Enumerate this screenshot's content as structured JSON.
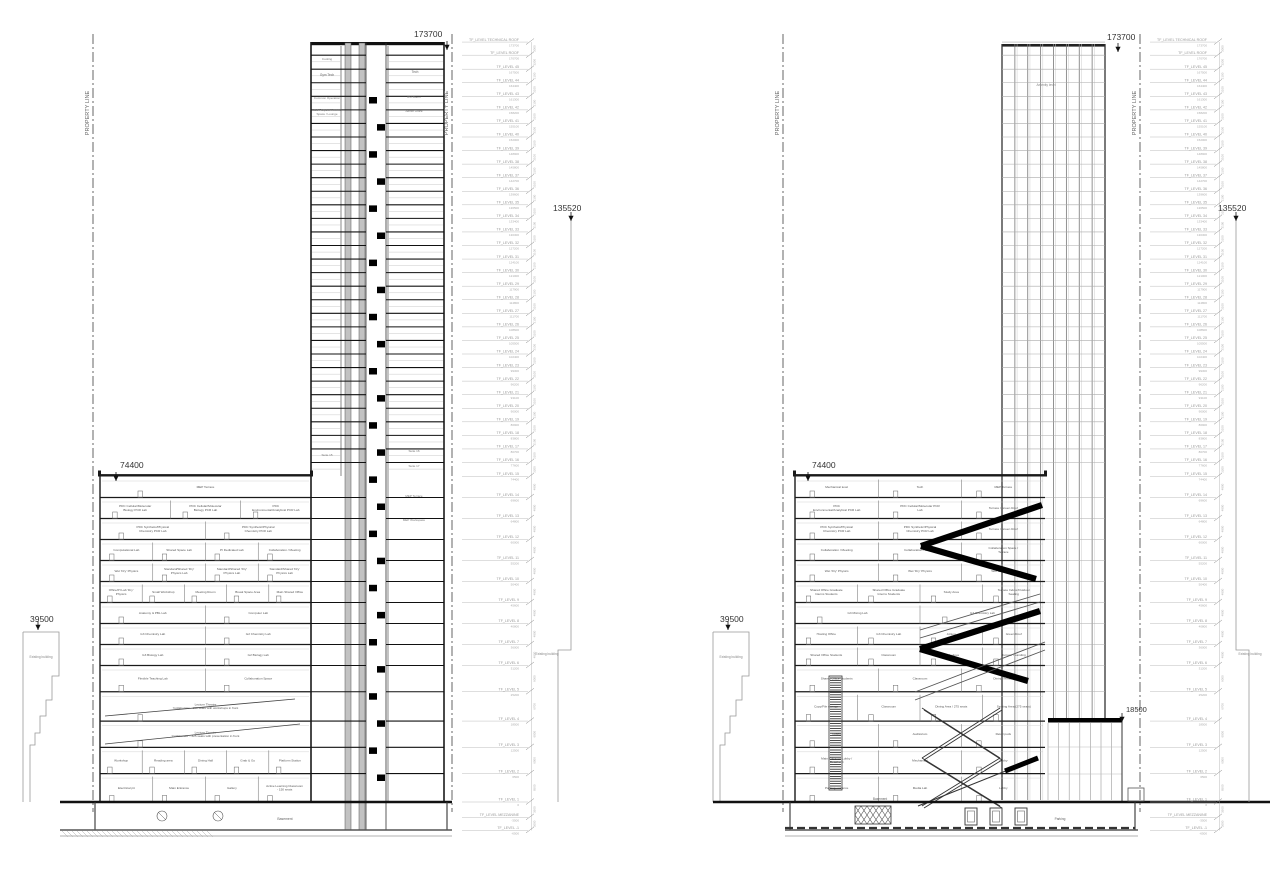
{
  "annotations": {
    "property_line": "PROPERTY LINE",
    "existing_building": "Existing building"
  },
  "markers": {
    "left_section": {
      "roof": "173700",
      "podium_roof": "74400",
      "existing_left": "39500",
      "existing_right": "135520"
    },
    "right_section": {
      "roof": "173700",
      "podium_roof": "74400",
      "existing_left": "39500",
      "existing_right": "135520",
      "annex_roof": "18500"
    }
  },
  "levels": [
    {
      "name": "TF_LEVEL TECHNICAL ROOF",
      "elev": 173700
    },
    {
      "name": "TF_LEVEL ROOF",
      "elev": 170700
    },
    {
      "name": "TF_LEVEL 45",
      "elev": 167500
    },
    {
      "name": "TF_LEVEL 44",
      "elev": 164400
    },
    {
      "name": "TF_LEVEL 43",
      "elev": 161300
    },
    {
      "name": "TF_LEVEL 42",
      "elev": 158200
    },
    {
      "name": "TF_LEVEL 41",
      "elev": 155100
    },
    {
      "name": "TF_LEVEL 40",
      "elev": 152000
    },
    {
      "name": "TF_LEVEL 39",
      "elev": 148900
    },
    {
      "name": "TF_LEVEL 38",
      "elev": 145800
    },
    {
      "name": "TF_LEVEL 37",
      "elev": 142700
    },
    {
      "name": "TF_LEVEL 36",
      "elev": 139600
    },
    {
      "name": "TF_LEVEL 35",
      "elev": 136500
    },
    {
      "name": "TF_LEVEL 34",
      "elev": 133400
    },
    {
      "name": "TF_LEVEL 33",
      "elev": 130300
    },
    {
      "name": "TF_LEVEL 32",
      "elev": 127200
    },
    {
      "name": "TF_LEVEL 31",
      "elev": 124100
    },
    {
      "name": "TF_LEVEL 30",
      "elev": 121000
    },
    {
      "name": "TF_LEVEL 29",
      "elev": 117900
    },
    {
      "name": "TF_LEVEL 28",
      "elev": 114800
    },
    {
      "name": "TF_LEVEL 27",
      "elev": 111700
    },
    {
      "name": "TF_LEVEL 26",
      "elev": 108600
    },
    {
      "name": "TF_LEVEL 25",
      "elev": 105500
    },
    {
      "name": "TF_LEVEL 24",
      "elev": 102400
    },
    {
      "name": "TF_LEVEL 23",
      "elev": 99300
    },
    {
      "name": "TF_LEVEL 22",
      "elev": 96200
    },
    {
      "name": "TF_LEVEL 21",
      "elev": 93100
    },
    {
      "name": "TF_LEVEL 20",
      "elev": 90000
    },
    {
      "name": "TF_LEVEL 19",
      "elev": 86900
    },
    {
      "name": "TF_LEVEL 18",
      "elev": 83800
    },
    {
      "name": "TF_LEVEL 17",
      "elev": 80700
    },
    {
      "name": "TF_LEVEL 16",
      "elev": 77600
    },
    {
      "name": "TF_LEVEL 15",
      "elev": 74400
    },
    {
      "name": "TF_LEVEL 14",
      "elev": 69600
    },
    {
      "name": "TF_LEVEL 13",
      "elev": 64800
    },
    {
      "name": "TF_LEVEL 12",
      "elev": 60000
    },
    {
      "name": "TF_LEVEL 11",
      "elev": 55200
    },
    {
      "name": "TF_LEVEL 10",
      "elev": 50400
    },
    {
      "name": "TF_LEVEL 9",
      "elev": 45600
    },
    {
      "name": "TF_LEVEL 8",
      "elev": 40800
    },
    {
      "name": "TF_LEVEL 7",
      "elev": 36000
    },
    {
      "name": "TF_LEVEL 6",
      "elev": 31200
    },
    {
      "name": "TF_LEVEL 5",
      "elev": 25200
    },
    {
      "name": "TF_LEVEL 4",
      "elev": 18500
    },
    {
      "name": "TF_LEVEL 3",
      "elev": 12500
    },
    {
      "name": "TF_LEVEL 2",
      "elev": 6500
    },
    {
      "name": "TF_LEVEL 1",
      "elev": 0
    },
    {
      "name": "TF_LEVEL MEZZANINE",
      "elev": -3500
    },
    {
      "name": "TF_LEVEL -1",
      "elev": -6500
    }
  ],
  "left_section": {
    "tower_top_labels": {
      "cooling": "Cooling",
      "gym_tech": "Gym Tech",
      "tech": "Tech",
      "common_operation": "Common Operation",
      "ru_room": "RU Room",
      "amenity": "Multi-Purpose Amenity Space / Lounge",
      "admin_office": "Admin Office"
    },
    "suite_labels": [
      "Suite 15",
      "Suite 16",
      "Suite 17"
    ],
    "mep_labels": [
      "MEP Terrace",
      "MEP Workspace"
    ],
    "podium_floors": [
      [
        "MEP Terrace"
      ],
      [
        "PDC Cellular/Molecular Biology PCR Lab",
        "PDC Cellular/Molecular Biology PCR Lab",
        "PDC Environmental/Analytical PCR Lab"
      ],
      [
        "PDC Synthetic/Physical Chemistry PCR Lab",
        "PDC Synthetic/Physical Chemistry PCR Lab"
      ],
      [
        "Computational Lab",
        "Shared Space Lab",
        "PI Dedicated Lab",
        "Collaboration / Meeting"
      ],
      [
        "Wet 'Dry' Physics",
        "Standard/Shared 'Dry' Physics Lab",
        "Standard/Shared 'Dry' Physics Lab",
        "Standard/Shared 'Dry' Physics Lab"
      ],
      [
        "Office/PI Lab 'Dry' Physics",
        "Small Workshop",
        "Meeting Room",
        "Break Space Area",
        "Main Shared Office"
      ],
      [
        "Anatomy & PBL Lab",
        "Computer Lab"
      ],
      [
        "G3 Chemistry Lab",
        "G2 Chemistry Lab"
      ],
      [
        "G3 Biology Lab",
        "G2 Biology Lab"
      ],
      [
        "Flexible Teaching Lab",
        "Collaboration Space"
      ],
      [
        "Lecture Theatre 'Collaborate' - 150 seats with workshops in front"
      ],
      [
        "Lecture Theatre 'Collaborate' - 325 seats with presentation in front"
      ],
      [
        "Workshop",
        "Reading area",
        "Dining Hall",
        "Grab & Go",
        "Platform Station"
      ],
      [
        "Electrical pit",
        "Main Entrance",
        "Gallery",
        "Active Learning Classroom - 150 seats"
      ]
    ],
    "basement_label": "Basement"
  },
  "right_section": {
    "tower_label": "Amenity level",
    "podium_floors": [
      [
        "Mechanical level",
        "Tech",
        "MEP Terrace"
      ],
      [
        "PDC Environmental/Analytical PCR Lab",
        "PDC Cellular/Molecular PCR Lab",
        "Terrace / Green Roof"
      ],
      [
        "PDC Synthetic/Physical Chemistry PCR Lab",
        "PDC Synthetic/Physical Chemistry PCR Lab",
        "Terrace / Green Roof"
      ],
      [
        "Collaboration / Meeting",
        "Collaboration / Meeting",
        "Collaboration Space / Terrace"
      ],
      [
        "Wet 'Dry' Physics",
        "Wet 'Dry' Physics",
        "Wet 'Dry' Physics"
      ],
      [
        "Shared Office Graduate Interns Students",
        "Shared Office Graduate Interns Students",
        "Study Area",
        "Terrace Indoor/Outdoor Seating"
      ],
      [
        "G3 Mixing Lab",
        "G2 Chemistry Lab"
      ],
      [
        "Hosting Office",
        "G3 Chemistry Lab",
        "Atrium",
        "Green Roof"
      ],
      [
        "Shared Office Students",
        "Classroom",
        "Study Area",
        "Terrace / Landing"
      ],
      [
        "Shared Office Students",
        "Classroom",
        "Dining Terrace"
      ],
      [
        "Copy/File storage",
        "Classroom",
        "Dining Area / 275 seats",
        "Seating Area (275 seats)"
      ],
      [
        "Lobby",
        "Auditorium",
        "Retail pods"
      ],
      [
        "Main Entrance Lobby / Retail unit",
        "Mechanical",
        "Lobby"
      ],
      [
        "Parking entrance",
        "Media Lab",
        "Lobby"
      ]
    ],
    "basement_labels": [
      "Basement",
      "Parking"
    ]
  }
}
